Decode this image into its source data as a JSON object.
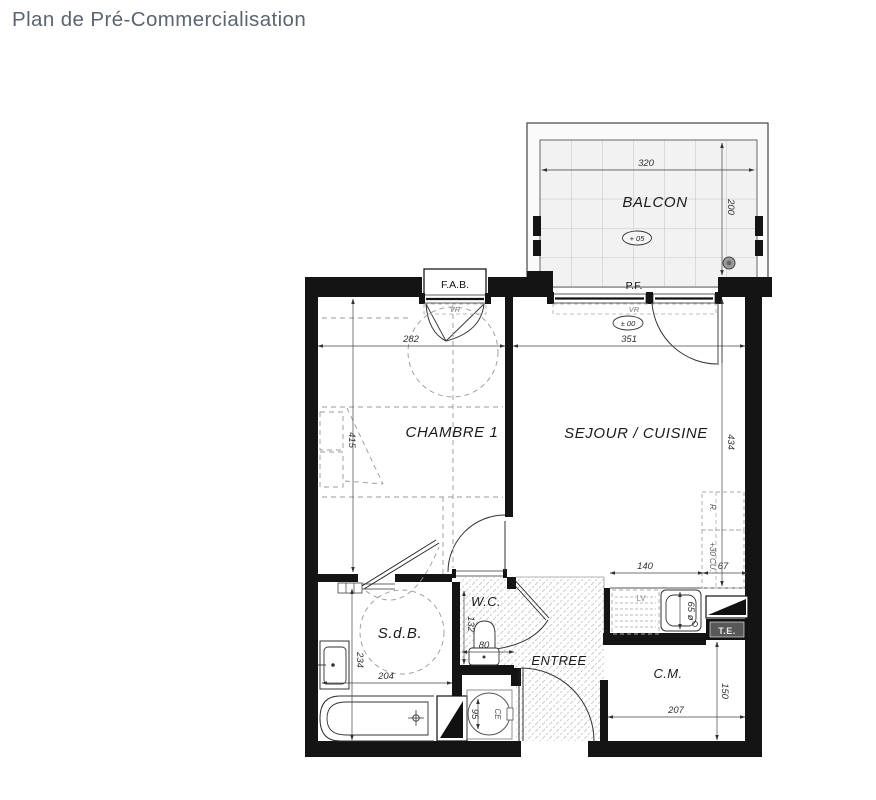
{
  "title": "Plan de Pré-Commercialisation",
  "rooms": {
    "balcon": "BALCON",
    "chambre": "CHAMBRE 1",
    "sejour": "SEJOUR / CUISINE",
    "sdb": "S.d.B.",
    "wc": "W.C.",
    "entree": "ENTREE",
    "cm": "C.M."
  },
  "labels": {
    "fab": "F.A.B.",
    "pf": "P.F.",
    "vr_chambre": "VR",
    "vr_sejour": "VR",
    "te": "T.E.",
    "lv": "LV",
    "ce": "CE",
    "refrigerateur": "R.",
    "cuisson": "+30 CU."
  },
  "elevations": {
    "balcon": "+ 05",
    "sejour": "± 00"
  },
  "dimensions": {
    "balcon_width": "320",
    "balcon_depth": "200",
    "chambre_width": "282",
    "sejour_width": "351",
    "chambre_depth": "415",
    "sejour_depth": "434",
    "cuisine_counter": "140",
    "cuisine_side": "67",
    "sdb_width": "204",
    "sdb_depth": "234",
    "wc_width": "80",
    "wc_depth": "132",
    "evier": "65 ø",
    "chauffe_eau": "95",
    "cm_width": "207",
    "cm_depth": "150"
  },
  "colors": {
    "title": "#5b6570",
    "walls": "#141414",
    "hatch": "#c7c7c7"
  }
}
